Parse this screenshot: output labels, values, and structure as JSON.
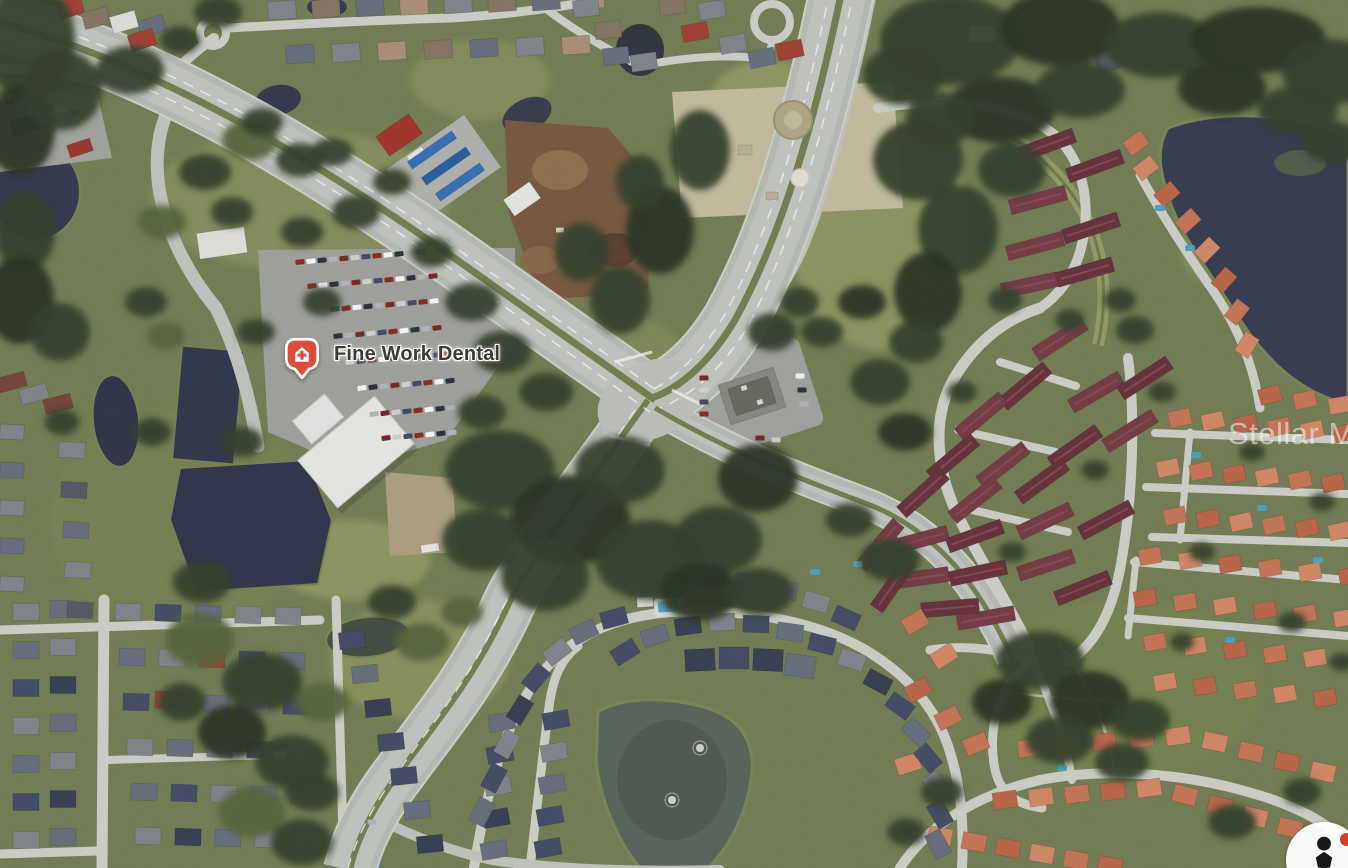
{
  "page": {
    "width_px": 1348,
    "height_px": 868,
    "kind": "aerial-satellite-map-view"
  },
  "map": {
    "view": "satellite-aerial",
    "poi_marker": {
      "label": "Fine Work Dental",
      "icon": "medical-building-pin-icon",
      "pin_fill": "#DE4A3B",
      "pin_border": "#FFFFFF",
      "glyph_color": "#FFFFFF",
      "label_color": "#3D3935",
      "label_halo": "#FFFFFF"
    },
    "watermark": {
      "text": "Stellar MLS",
      "color": "#FFFFFF",
      "opacity": 0.5
    },
    "street_view_control": {
      "icon": "pegman-person-icon",
      "background": "#FFFFFF",
      "person_color": "#17181A",
      "notification_dot_color": "#D63A2A"
    },
    "imagery_palette": {
      "grass": "#79855A",
      "trees": "#3A462E",
      "lake_water": "#3C4156",
      "pond_gray": "#5F6A61",
      "highway": "#C3C7C1",
      "local_road": "#D6D8D0",
      "parking_lot": "#A7A9A3",
      "white_roof_building": "#F1F1EE",
      "maroon_townhouse_roof": "#6E3741",
      "orange_house_roof": "#CD7C5B",
      "gray_house_roof": "#878B92",
      "navy_house_roof": "#48526B",
      "dirt": "#7E5F45",
      "sand_pad": "#CDC4A6"
    }
  }
}
